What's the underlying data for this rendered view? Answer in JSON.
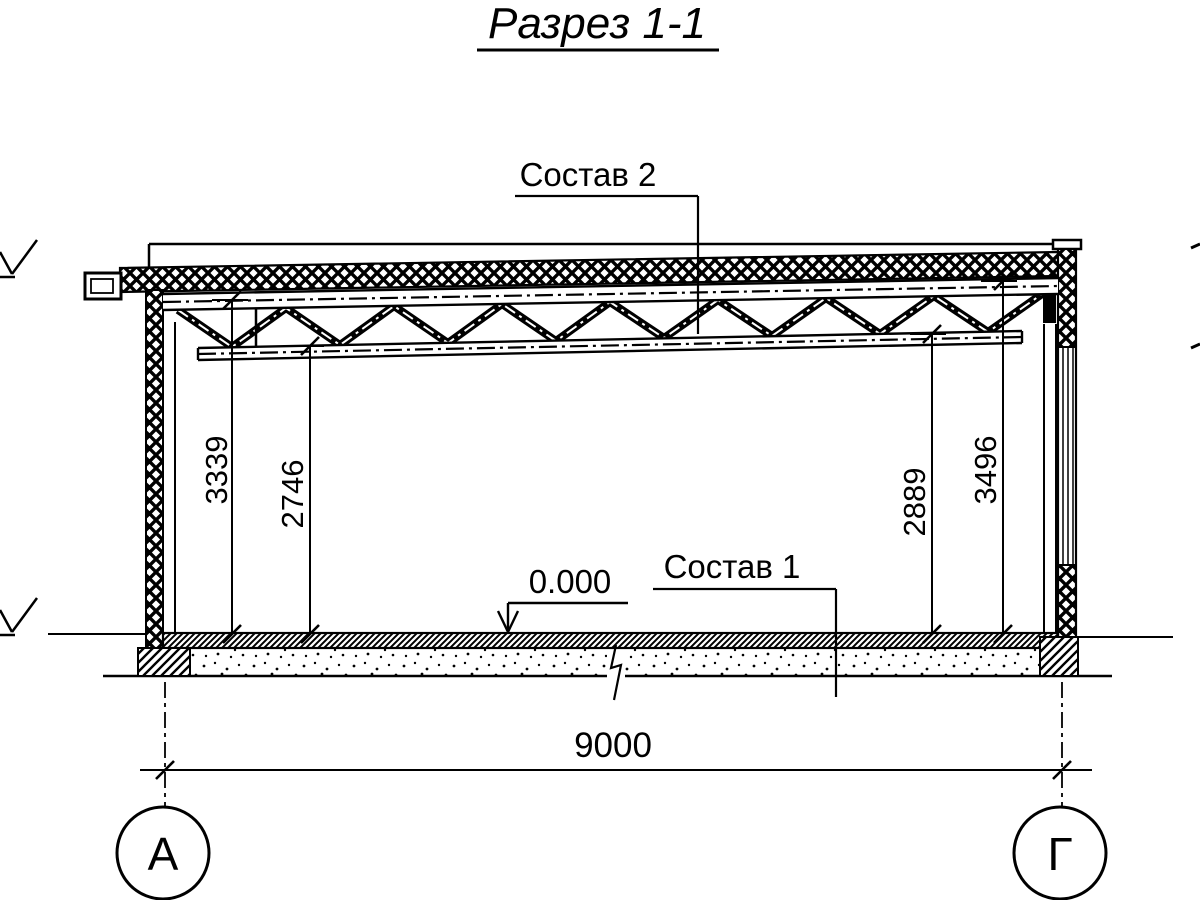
{
  "title": "Разрез 1-1",
  "callouts": {
    "roof_composition": "Состав 2",
    "floor_composition": "Состав 1",
    "floor_level_mark": "0.000"
  },
  "dimensions": {
    "left_to_truss_top": "3339",
    "left_to_truss_bottom": "2746",
    "right_to_truss_bottom": "2889",
    "right_to_truss_top": "3496",
    "span": "9000"
  },
  "axes": {
    "left_label": "А",
    "right_label": "Г"
  },
  "colors": {
    "ink": "#000000",
    "paper": "#ffffff"
  }
}
